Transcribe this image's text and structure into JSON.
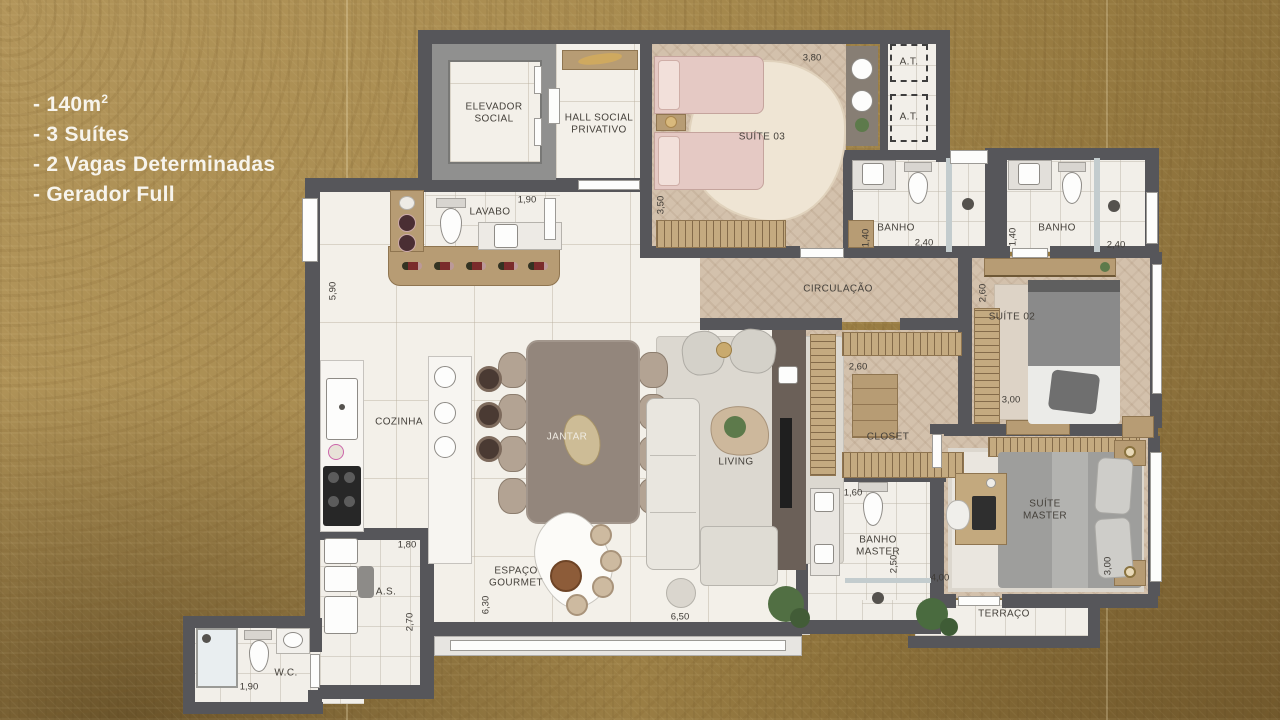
{
  "info_panel": {
    "items": [
      {
        "text": "- 140m",
        "sup": "2"
      },
      {
        "text": "- 3 Suítes",
        "sup": ""
      },
      {
        "text": "- 2 Vagas Determinadas",
        "sup": ""
      },
      {
        "text": "- Gerador Full",
        "sup": ""
      }
    ]
  },
  "rooms": {
    "elevador_social": {
      "line1": "ELEVADOR",
      "line2": "SOCIAL"
    },
    "hall_social": {
      "line1": "HALL SOCIAL",
      "line2": "PRIVATIVO"
    },
    "suite03": {
      "label": "SUÍTE 03"
    },
    "at_upper": {
      "label": "A.T."
    },
    "at_lower": {
      "label": "A.T."
    },
    "banho_suite03": {
      "label": "BANHO"
    },
    "banho_suite02": {
      "label": "BANHO"
    },
    "circulacao": {
      "label": "CIRCULAÇÃO"
    },
    "suite02": {
      "label": "SUÍTE 02"
    },
    "closet": {
      "label": "CLOSET"
    },
    "lavabo": {
      "label": "LAVABO"
    },
    "cozinha": {
      "label": "COZINHA"
    },
    "jantar": {
      "label": "JANTAR"
    },
    "living": {
      "label": "LIVING"
    },
    "espaco_gourmet": {
      "line1": "ESPAÇO",
      "line2": "GOURMET"
    },
    "area_servico": {
      "label": "A.S."
    },
    "wc": {
      "label": "W.C."
    },
    "banho_master": {
      "line1": "BANHO",
      "line2": "MASTER"
    },
    "suite_master": {
      "line1": "SUÍTE",
      "line2": "MASTER"
    },
    "terraco": {
      "label": "TERRAÇO"
    }
  },
  "dims": {
    "suite03_w": "3,80",
    "suite03_h": "3,50",
    "banho1_h": "1,40",
    "banho1_w": "2,40",
    "banho2_h": "1,40",
    "banho2_w": "2,40",
    "lavabo_w": "1,90",
    "cozinha_h": "5,90",
    "as_w": "1,80",
    "as_h": "2,70",
    "wc_w": "1,90",
    "gourmet_h": "6,30",
    "living_w": "6,50",
    "suite02_h": "2,60",
    "suite02_w": "3,00",
    "closet_w": "2,60",
    "banho_master_w": "1,60",
    "banho_master_h": "2,50",
    "suite_master_w": "4,00",
    "suite_master_h": "3,00"
  },
  "colors": {
    "background_gold": "#a98c50",
    "wall": "#56565a",
    "wood": "#b79c74"
  }
}
